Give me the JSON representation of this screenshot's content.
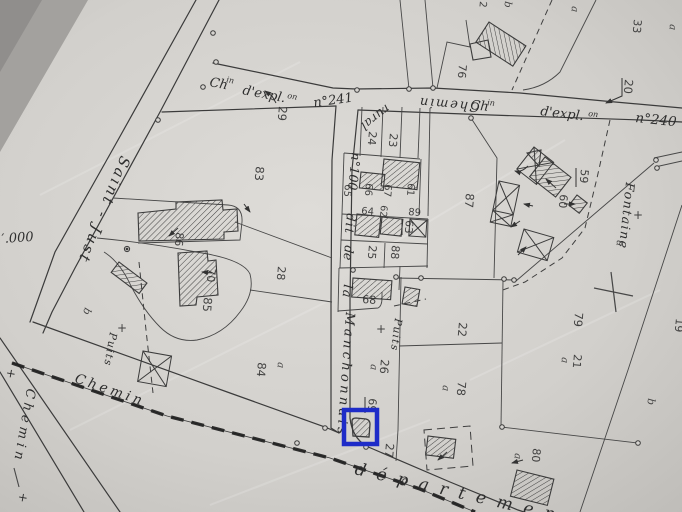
{
  "colors": {
    "highlight": "#1e2cc8",
    "paper": "#d6d4d0",
    "ink": "#3b3b3b"
  },
  "scale_fragment": "′.000",
  "roads": {
    "saint_just": "Saint - Just",
    "chemin_rural": "Chemin",
    "rural": "rural",
    "expl241_ch": "Ch",
    "expl241_sup": "in",
    "expl241_body": "d'expl.",
    "expl241_sup2": "on",
    "expl241_num": "n°241",
    "expl240_ch": "Ch",
    "expl240_sup": "in",
    "expl240_body": "d'expl.",
    "expl240_sup2": "on",
    "expl240_num": "n°240",
    "manchonnais_n100": "n°100",
    "manchonnais_dit": "dit",
    "manchonnais_de": "de",
    "manchonnais_la": "la",
    "manchonnais_name": "Manchonnais",
    "chemin_bottom": "Chemin",
    "departementale": "départemen",
    "chemin_left": "Chemin",
    "cross_top": "+",
    "cross_bottom": "+"
  },
  "poi": {
    "fontaine": "Fontaine",
    "fontaine_cross": "+",
    "puits_east": "Puits",
    "puits_east_cross": "+",
    "puits_west": "Puits",
    "puits_west_cross": "+"
  },
  "parcels": {
    "n19": "19",
    "n20": "20",
    "n21": "21",
    "n21a": "a",
    "n22": "22",
    "n23": "23",
    "n24": "24",
    "n25": "25",
    "n26": "26",
    "n26a": "a",
    "n27": "27",
    "n28": "28",
    "n29": "29",
    "n33": "33",
    "n59": "59",
    "n60": "60",
    "n61": "61",
    "n62": "62",
    "n63": "63",
    "n64": "64",
    "n65": "65",
    "n66": "66",
    "n67": "67",
    "n68": "68",
    "n69": "69",
    "n70": "70",
    "n76": "76",
    "n78": "78",
    "n78a": "a",
    "n79": "79",
    "n80": "80",
    "n80a": "a",
    "n83": "83",
    "n84": "84",
    "n84a": "a",
    "n85": "85",
    "n86": "86",
    "n87": "87",
    "n88": "88",
    "n89": "89",
    "a_top_left": "a",
    "a_top_right": "a",
    "b_top": "b",
    "n2_top": "2",
    "a_right_mid": "a",
    "b_right": "b",
    "b_left": "b"
  }
}
